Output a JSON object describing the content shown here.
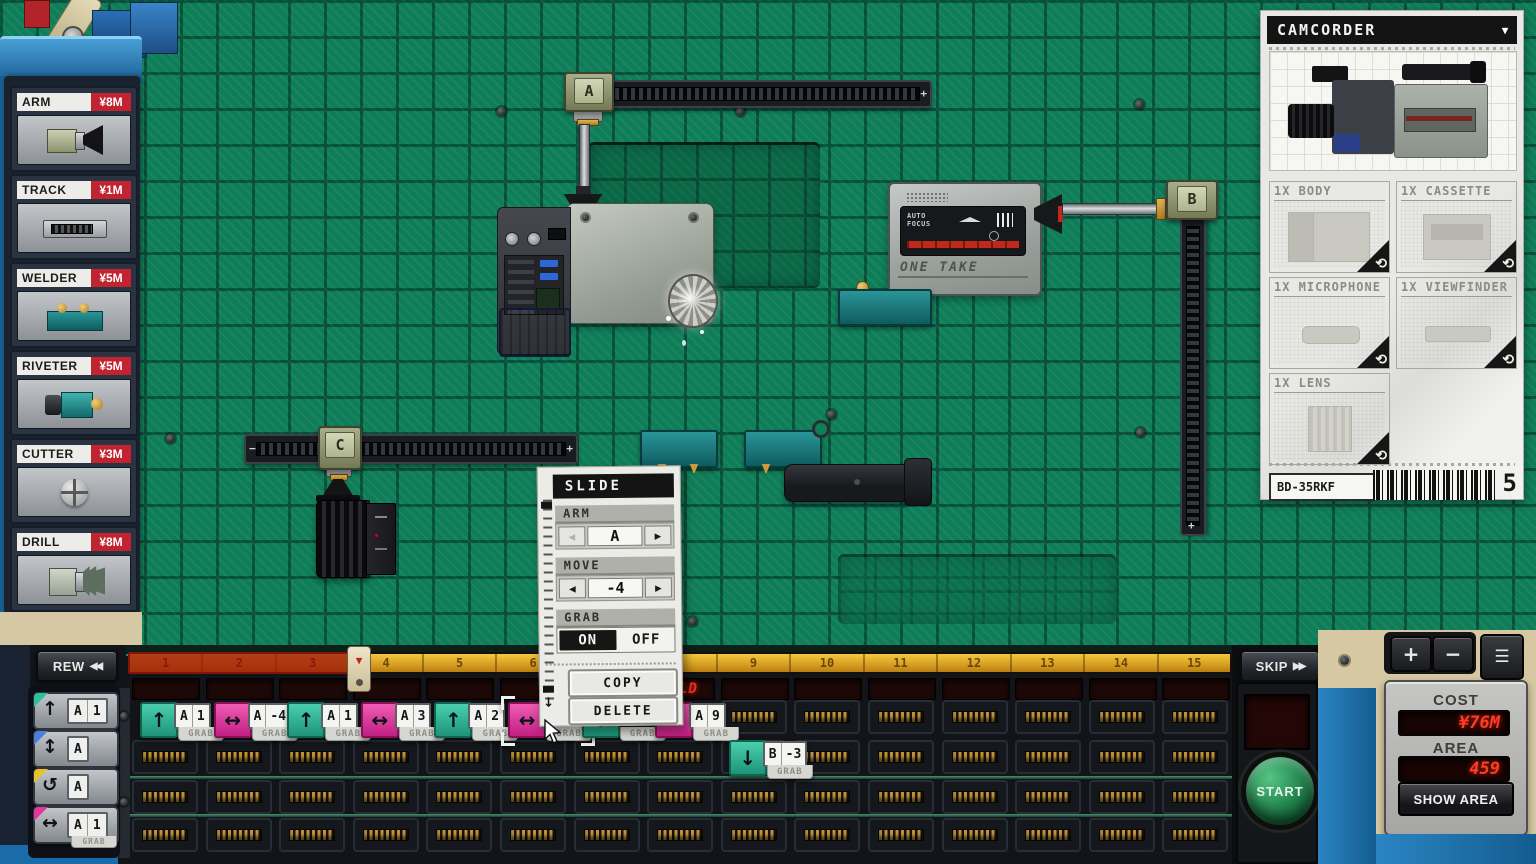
{
  "tool_shop": {
    "items": [
      {
        "name": "ARM",
        "price": "¥8M",
        "icon": "arm"
      },
      {
        "name": "TRACK",
        "price": "¥1M",
        "icon": "track"
      },
      {
        "name": "WELDER",
        "price": "¥5M",
        "icon": "welder"
      },
      {
        "name": "RIVETER",
        "price": "¥5M",
        "icon": "riveter"
      },
      {
        "name": "CUTTER",
        "price": "¥3M",
        "icon": "cutter"
      },
      {
        "name": "DRILL",
        "price": "¥8M",
        "icon": "drill"
      }
    ]
  },
  "board": {
    "arm_a": "A",
    "arm_b": "B",
    "arm_c": "C",
    "plus": "+",
    "minus": "−",
    "one_take_brand": "ONE TAKE",
    "auto_focus_line1": "AUTO",
    "auto_focus_line2": "FOCUS"
  },
  "product_panel": {
    "title": "CAMCORDER",
    "dropdown_icon": "▼",
    "parts": [
      {
        "label": "1X BODY"
      },
      {
        "label": "1X CASSETTE"
      },
      {
        "label": "1X MICROPHONE"
      },
      {
        "label": "1X VIEWFINDER"
      },
      {
        "label": "1X LENS"
      }
    ],
    "rotate_icon": "⟲",
    "model_code": "BD-35RKF",
    "queue_count": "5"
  },
  "slide_popup": {
    "title": "SLIDE",
    "arm_label": "ARM",
    "arm_value": "A",
    "move_label": "MOVE",
    "move_value": "-4",
    "grab_label": "GRAB",
    "grab_on": "ON",
    "grab_off": "OFF",
    "prev_icon": "◀",
    "next_icon": "▶",
    "copy_label": "COPY",
    "delete_label": "DELETE",
    "marker_icon": "↓"
  },
  "timeline": {
    "rew_label": "REW",
    "rew_icon": "◀◀",
    "skip_label": "SKIP",
    "skip_icon": "▶▶",
    "ruler_numbers": [
      "1",
      "2",
      "3",
      "4",
      "5",
      "6",
      "7",
      "8",
      "9",
      "10",
      "11",
      "12",
      "13",
      "14",
      "15"
    ],
    "led_message": "WELD",
    "command_palette": [
      {
        "icon": "↑",
        "color": "teal",
        "arm": "A",
        "value": "1",
        "sub": ""
      },
      {
        "icon": "↕",
        "color": "blue",
        "arm": "A",
        "value": "",
        "sub": ""
      },
      {
        "icon": "↺",
        "color": "yellow",
        "arm": "A",
        "value": "",
        "sub": ""
      },
      {
        "icon": "↔",
        "color": "pink",
        "arm": "A",
        "value": "1",
        "sub": "GRAB"
      }
    ],
    "chips_row1": [
      {
        "slot": 1,
        "color": "teal",
        "icon": "↑",
        "arm": "A",
        "value": "1",
        "sub": "GRAB",
        "selected": false
      },
      {
        "slot": 2,
        "color": "pink",
        "icon": "↔",
        "arm": "A",
        "value": "-4",
        "sub": "GRAB",
        "selected": false
      },
      {
        "slot": 3,
        "color": "teal",
        "icon": "↑",
        "arm": "A",
        "value": "1",
        "sub": "GRAB",
        "selected": false
      },
      {
        "slot": 4,
        "color": "pink",
        "icon": "↔",
        "arm": "A",
        "value": "3",
        "sub": "GRAB",
        "selected": false
      },
      {
        "slot": 5,
        "color": "teal",
        "icon": "↑",
        "arm": "A",
        "value": "2",
        "sub": "GRAB",
        "selected": false
      },
      {
        "slot": 6,
        "color": "pink",
        "icon": "↔",
        "arm": "A",
        "value": "-4",
        "sub": "GRAB",
        "selected": true
      },
      {
        "slot": 7,
        "color": "teal",
        "icon": "↑",
        "arm": "",
        "value": "",
        "sub": "GRAB",
        "selected": false
      },
      {
        "slot": 8,
        "color": "pink",
        "icon": "↔",
        "arm": "A",
        "value": "9",
        "sub": "GRAB",
        "selected": false
      }
    ],
    "chips_row2": [
      {
        "slot": 9,
        "color": "teal",
        "icon": "↓",
        "arm": "B",
        "value": "-3",
        "sub": "GRAB",
        "selected": false
      }
    ]
  },
  "control_panel": {
    "start_label": "START",
    "cost_label": "COST",
    "cost_value": "¥76M",
    "area_label": "AREA",
    "area_value": "459",
    "show_area_label": "SHOW AREA",
    "zoom_in_icon": "+",
    "zoom_out_icon": "−",
    "menu_icon": "☰"
  }
}
